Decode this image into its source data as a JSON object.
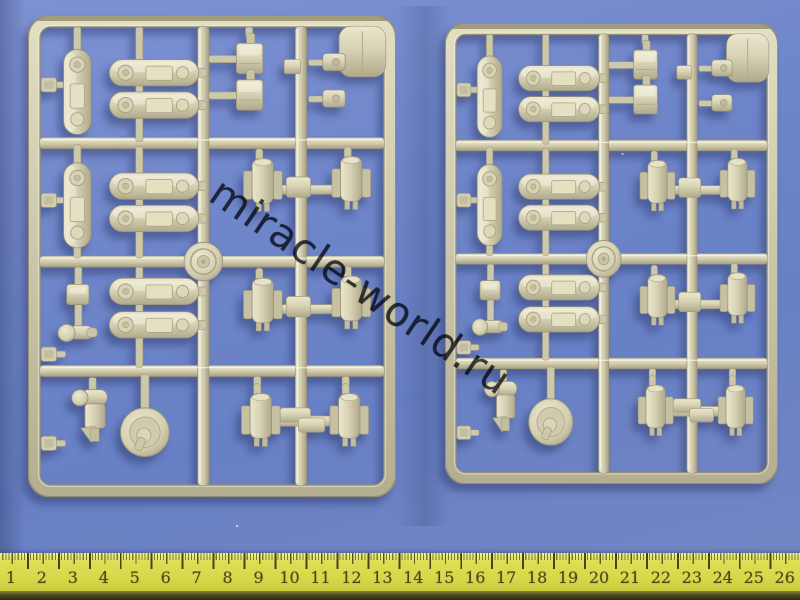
{
  "scene": {
    "description": "Photo of two identical tan plastic model-kit sprues with suspension parts on a blue background, yellow centimeter ruler along the bottom",
    "background_color": "#6e85c9",
    "sprue_plastic_color": "#d5d0b3",
    "ruler_color": "#d7d849",
    "ruler_number_color": "#4c471d",
    "watermark_color": "#282b35"
  },
  "watermark": {
    "text": "miracle-world.ru"
  },
  "ruler": {
    "unit": "cm",
    "numbers": [
      "1",
      "2",
      "3",
      "4",
      "5",
      "6",
      "7",
      "8",
      "9",
      "10",
      "11",
      "12",
      "13",
      "14",
      "15",
      "16",
      "17",
      "18",
      "19",
      "20",
      "21",
      "22",
      "23",
      "24",
      "25",
      "26"
    ]
  },
  "sprues": [
    {
      "id": "left-sprue"
    },
    {
      "id": "right-sprue"
    }
  ]
}
